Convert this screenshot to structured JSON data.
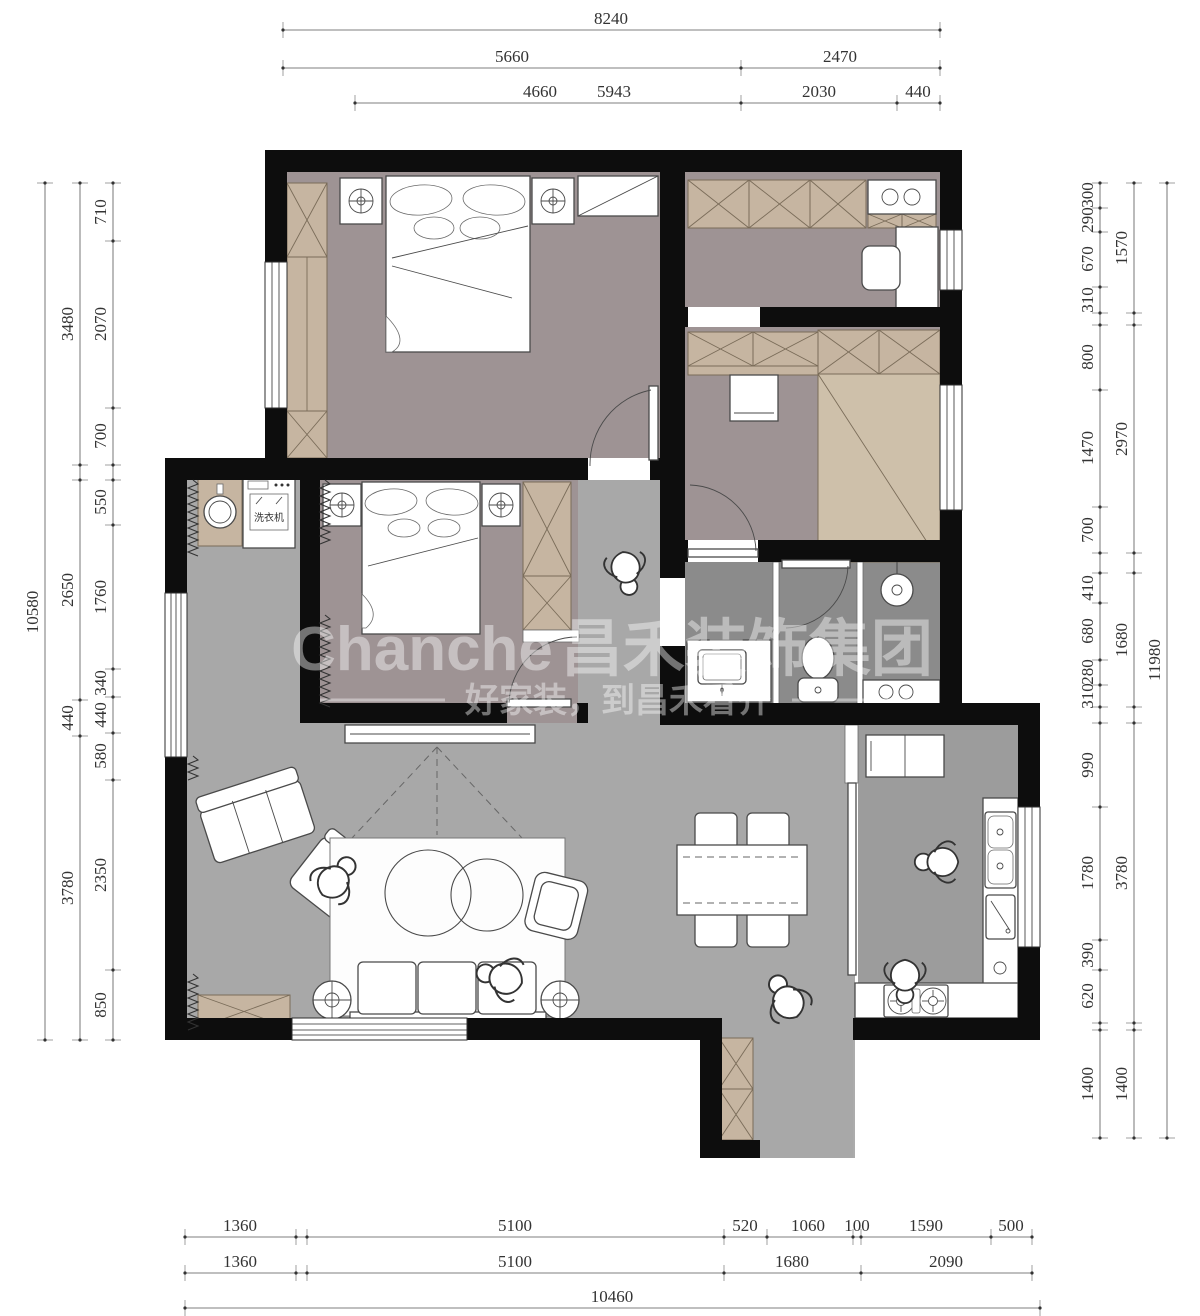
{
  "watermark": {
    "brand": "Chanche",
    "brand_cn": "昌禾装饰集团",
    "slogan": "好家装，到昌禾看齐"
  },
  "labels": {
    "washing_machine": "洗衣机"
  },
  "colors": {
    "wall": "#0d0d0d",
    "floor_bedroom": "#9e9394",
    "floor_living": "#a8a8a8",
    "floor_bath": "#8b8b8b",
    "floor_kitchen": "#9c9c9c",
    "cabinet_tan": "#c6b5a1",
    "tatami": "#cec0aa",
    "dim_text": "#333333",
    "watermark": "#ffffff"
  },
  "dims": {
    "top": {
      "total": "8240",
      "row2": [
        "5660",
        "2470"
      ],
      "row3": [
        "4660",
        "5943",
        "2030",
        "440"
      ]
    },
    "bottom": {
      "row1": [
        "1360",
        "5100",
        "520",
        "1060",
        "100",
        "1590",
        "500"
      ],
      "row2": [
        "1360",
        "5100",
        "1680",
        "2090"
      ],
      "total": "10460"
    },
    "left": {
      "total": "10580",
      "groups": [
        "3480",
        "2650",
        "440",
        "3780"
      ],
      "segments": [
        "710",
        "2070",
        "700",
        "550",
        "1760",
        "340",
        "440",
        "580",
        "2350",
        "850"
      ]
    },
    "right": {
      "total": "11980",
      "groups": [
        "1570",
        "2970",
        "1680",
        "3780",
        "1400"
      ],
      "segments": [
        "300",
        "290",
        "670",
        "310",
        "800",
        "1470",
        "700",
        "410",
        "680",
        "280",
        "310",
        "990",
        "1780",
        "390",
        "620",
        "1400"
      ]
    }
  }
}
